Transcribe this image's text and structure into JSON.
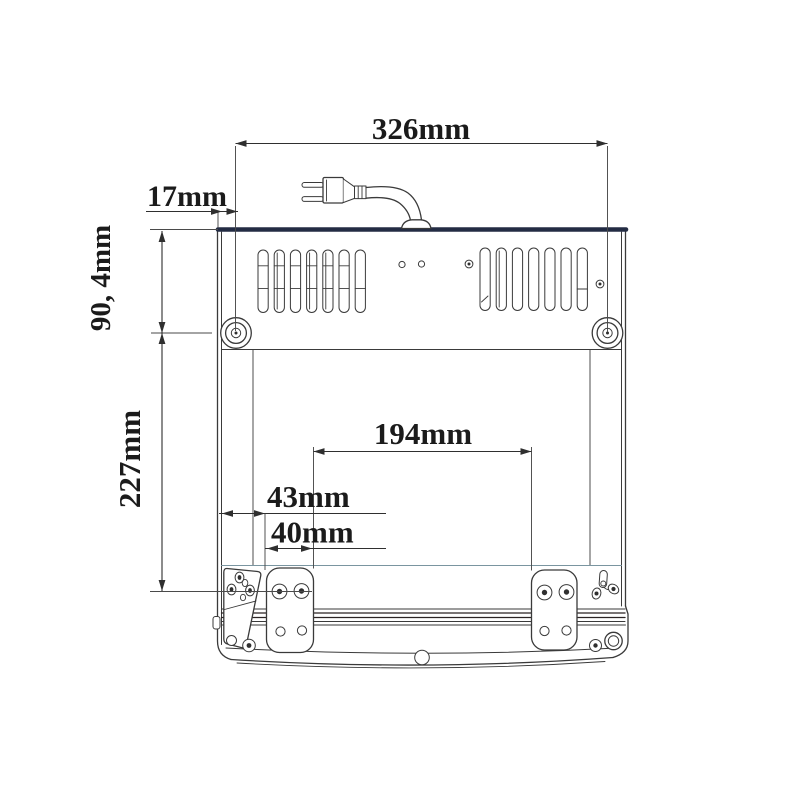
{
  "drawing": {
    "kind": "technical dimension drawing",
    "subject": "appliance back panel with power plug, vent slots, mounting screws and wall-mount plates",
    "units": "mm",
    "dimensions": {
      "total_width": {
        "label": "326mm",
        "value": 326
      },
      "edge_to_mount": {
        "label": "17mm",
        "value": 17
      },
      "top_to_mount": {
        "label": "90, 4mm",
        "value": 90.4
      },
      "mount_to_bracket": {
        "label": "227mm",
        "value": 227
      },
      "plate_spacing": {
        "label": "194mm",
        "value": 194
      },
      "edge_to_plate": {
        "label": "43mm",
        "value": 43
      },
      "plate_width": {
        "label": "40mm",
        "value": 40
      }
    },
    "colors": {
      "line": "#3a3a3a",
      "dimension_line": "#2f2f2f",
      "top_edge": "#232c44",
      "tray_line": "#7a95a0",
      "paper": "#ffffff",
      "text": "#1b1b1b"
    }
  }
}
